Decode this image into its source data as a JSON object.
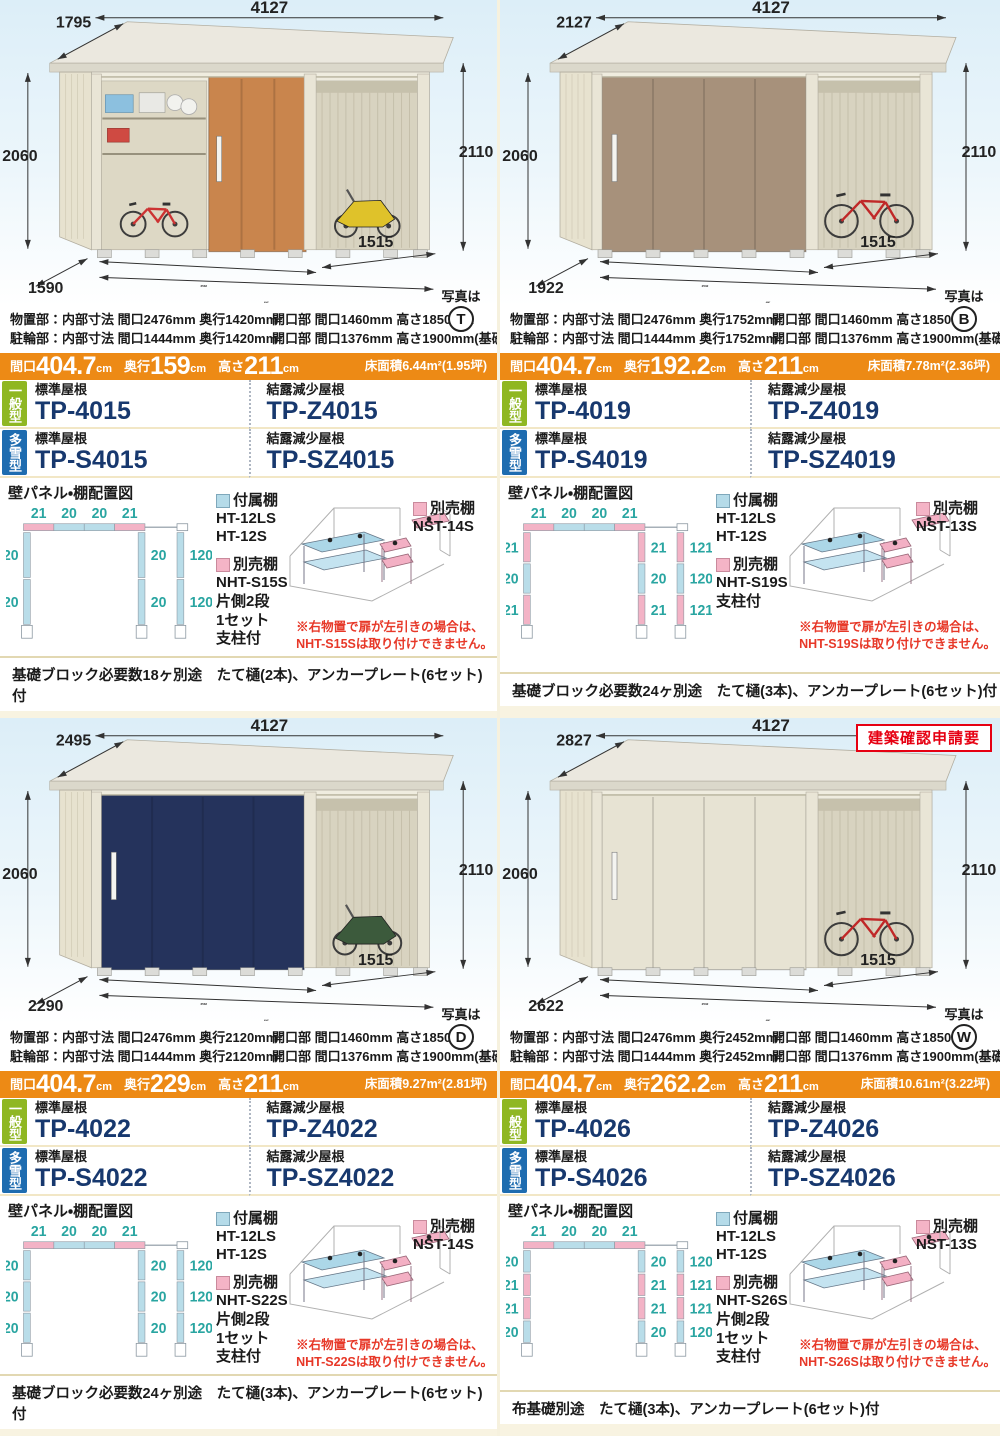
{
  "colors": {
    "size_bar_orange": "#ed8a15",
    "model_code_navy": "#17386e",
    "badge_green": "#8fb722",
    "badge_blue": "#1e6cb0",
    "diagram_teal": "#29a5a1",
    "panel_blue": "#b5dbe9",
    "panel_pink": "#f4b4c6",
    "warning_red": "#e73828",
    "permit_red": "#e60012"
  },
  "panels": [
    {
      "photo": {
        "letter": "T",
        "ref_label": "写真は",
        "scene": "kids",
        "door_color": "#c9854d",
        "dims": {
          "width": "4127",
          "roof_depth": "1795",
          "height_left": "2060",
          "height_right": "2110",
          "floor_front": "2532",
          "floor_total": "4047",
          "bay": "1515",
          "floor_depth": "1590"
        }
      },
      "specs": {
        "line1_left": "物置部：内部寸法 間口2476mm 奥行1420mm",
        "line1_right": "開口部 間口1460mm 高さ1850mm",
        "line2_left": "駐輪部：内部寸法 間口1444mm 奥行1420mm",
        "line2_right": "開口部 間口1376mm 高さ1900mm(基礎天)"
      },
      "size_bar": {
        "w_label": "間口",
        "w": "404.7",
        "d_label": "奥行",
        "d": "159",
        "h_label": "高さ",
        "h": "211",
        "unit": "cm",
        "area": "床面積6.44m²(1.95坪)"
      },
      "models": {
        "general_badge": "一般型",
        "snow_badge": "多雪型",
        "standard_roof_label": "標準屋根",
        "dew_roof_label": "結露減少屋根",
        "general_standard": "TP-4015",
        "general_dew": "TP-Z4015",
        "snow_standard": "TP-S4015",
        "snow_dew": "TP-SZ4015"
      },
      "diagram": {
        "title": "壁パネル・棚配置図",
        "top": [
          "21",
          "20",
          "20",
          "21"
        ],
        "left": [
          "20",
          "20"
        ],
        "middle": [
          "20",
          "20"
        ],
        "right": [
          "120",
          "120"
        ]
      },
      "shelves": {
        "included_label": "付属棚",
        "included_items": [
          "HT-12LS",
          "HT-12S"
        ],
        "optional_label": "別売棚",
        "optional_lines": [
          "NHT-S15S",
          "片側2段",
          "1セット",
          "支柱付"
        ],
        "optional_side_label": "別売棚",
        "optional_side": "NST-14S",
        "warning1": "※右物置で扉が左引きの場合は、",
        "warning2": "NHT-S15Sは取り付けできません。"
      },
      "footer": "基礎ブロック必要数18ヶ別途　たて樋(2本)、アンカープレート(6セット)付"
    },
    {
      "photo": {
        "letter": "B",
        "ref_label": "写真は",
        "scene": "bike",
        "door_color": "#a7917b",
        "dims": {
          "width": "4127",
          "roof_depth": "2127",
          "height_left": "2060",
          "height_right": "2110",
          "floor_front": "2532",
          "floor_total": "4047",
          "bay": "1515",
          "floor_depth": "1922"
        }
      },
      "specs": {
        "line1_left": "物置部：内部寸法 間口2476mm 奥行1752mm",
        "line1_right": "開口部 間口1460mm 高さ1850mm",
        "line2_left": "駐輪部：内部寸法 間口1444mm 奥行1752mm",
        "line2_right": "開口部 間口1376mm 高さ1900mm(基礎天)"
      },
      "size_bar": {
        "w_label": "間口",
        "w": "404.7",
        "d_label": "奥行",
        "d": "192.2",
        "h_label": "高さ",
        "h": "211",
        "unit": "cm",
        "area": "床面積7.78m²(2.36坪)"
      },
      "models": {
        "general_badge": "一般型",
        "snow_badge": "多雪型",
        "standard_roof_label": "標準屋根",
        "dew_roof_label": "結露減少屋根",
        "general_standard": "TP-4019",
        "general_dew": "TP-Z4019",
        "snow_standard": "TP-S4019",
        "snow_dew": "TP-SZ4019"
      },
      "diagram": {
        "title": "壁パネル・棚配置図",
        "top": [
          "21",
          "20",
          "20",
          "21"
        ],
        "left": [
          "21",
          "20",
          "21"
        ],
        "middle": [
          "21",
          "20",
          "21"
        ],
        "right": [
          "121",
          "120",
          "121"
        ]
      },
      "shelves": {
        "included_label": "付属棚",
        "included_items": [
          "HT-12LS",
          "HT-12S"
        ],
        "optional_label": "別売棚",
        "optional_lines": [
          "NHT-S19S",
          "支柱付"
        ],
        "optional_side_label": "別売棚",
        "optional_side": "NST-13S",
        "warning1": "※右物置で扉が左引きの場合は、",
        "warning2": "NHT-S19Sは取り付けできません。"
      },
      "footer": "基礎ブロック必要数24ヶ別途　たて樋(3本)、アンカープレート(6セット)付"
    },
    {
      "photo": {
        "letter": "D",
        "ref_label": "写真は",
        "scene": "scooter",
        "door_color": "#25335c",
        "dims": {
          "width": "4127",
          "roof_depth": "2495",
          "height_left": "2060",
          "height_right": "2110",
          "floor_front": "2532",
          "floor_total": "4047",
          "bay": "1515",
          "floor_depth": "2290"
        }
      },
      "specs": {
        "line1_left": "物置部：内部寸法 間口2476mm 奥行2120mm",
        "line1_right": "開口部 間口1460mm 高さ1850mm",
        "line2_left": "駐輪部：内部寸法 間口1444mm 奥行2120mm",
        "line2_right": "開口部 間口1376mm 高さ1900mm(基礎天)"
      },
      "size_bar": {
        "w_label": "間口",
        "w": "404.7",
        "d_label": "奥行",
        "d": "229",
        "h_label": "高さ",
        "h": "211",
        "unit": "cm",
        "area": "床面積9.27m²(2.81坪)"
      },
      "models": {
        "general_badge": "一般型",
        "snow_badge": "多雪型",
        "standard_roof_label": "標準屋根",
        "dew_roof_label": "結露減少屋根",
        "general_standard": "TP-4022",
        "general_dew": "TP-Z4022",
        "snow_standard": "TP-S4022",
        "snow_dew": "TP-SZ4022"
      },
      "diagram": {
        "title": "壁パネル・棚配置図",
        "top": [
          "21",
          "20",
          "20",
          "21"
        ],
        "left": [
          "20",
          "20",
          "20"
        ],
        "middle": [
          "20",
          "20",
          "20"
        ],
        "right": [
          "120",
          "120",
          "120"
        ]
      },
      "shelves": {
        "included_label": "付属棚",
        "included_items": [
          "HT-12LS",
          "HT-12S"
        ],
        "optional_label": "別売棚",
        "optional_lines": [
          "NHT-S22S",
          "片側2段",
          "1セット",
          "支柱付"
        ],
        "optional_side_label": "別売棚",
        "optional_side": "NST-14S",
        "warning1": "※右物置で扉が左引きの場合は、",
        "warning2": "NHT-S22Sは取り付けできません。"
      },
      "footer": "基礎ブロック必要数24ヶ別途　たて樋(3本)、アンカープレート(6セット)付"
    },
    {
      "photo": {
        "letter": "W",
        "ref_label": "写真は",
        "scene": "bike",
        "door_color": "#e7e3d3",
        "permit": "建築確認申請要",
        "dims": {
          "width": "4127",
          "roof_depth": "2827",
          "height_left": "2060",
          "height_right": "2110",
          "floor_front": "2532",
          "floor_total": "4047",
          "bay": "1515",
          "floor_depth": "2622"
        }
      },
      "specs": {
        "line1_left": "物置部：内部寸法 間口2476mm 奥行2452mm",
        "line1_right": "開口部 間口1460mm 高さ1850mm",
        "line2_left": "駐輪部：内部寸法 間口1444mm 奥行2452mm",
        "line2_right": "開口部 間口1376mm 高さ1900mm(基礎天)"
      },
      "size_bar": {
        "w_label": "間口",
        "w": "404.7",
        "d_label": "奥行",
        "d": "262.2",
        "h_label": "高さ",
        "h": "211",
        "unit": "cm",
        "area": "床面積10.61m²(3.22坪)"
      },
      "models": {
        "general_badge": "一般型",
        "snow_badge": "多雪型",
        "standard_roof_label": "標準屋根",
        "dew_roof_label": "結露減少屋根",
        "general_standard": "TP-4026",
        "general_dew": "TP-Z4026",
        "snow_standard": "TP-S4026",
        "snow_dew": "TP-SZ4026"
      },
      "diagram": {
        "title": "壁パネル・棚配置図",
        "top": [
          "21",
          "20",
          "20",
          "21"
        ],
        "left": [
          "20",
          "21",
          "21",
          "20"
        ],
        "middle": [
          "20",
          "21",
          "21",
          "20"
        ],
        "right": [
          "120",
          "121",
          "121",
          "120"
        ]
      },
      "shelves": {
        "included_label": "付属棚",
        "included_items": [
          "HT-12LS",
          "HT-12S"
        ],
        "optional_label": "別売棚",
        "optional_lines": [
          "NHT-S26S",
          "片側2段",
          "1セット",
          "支柱付"
        ],
        "optional_side_label": "別売棚",
        "optional_side": "NST-13S",
        "warning1": "※右物置で扉が左引きの場合は、",
        "warning2": "NHT-S26Sは取り付けできません。"
      },
      "footer": "布基礎別途　たて樋(3本)、アンカープレート(6セット)付"
    }
  ]
}
